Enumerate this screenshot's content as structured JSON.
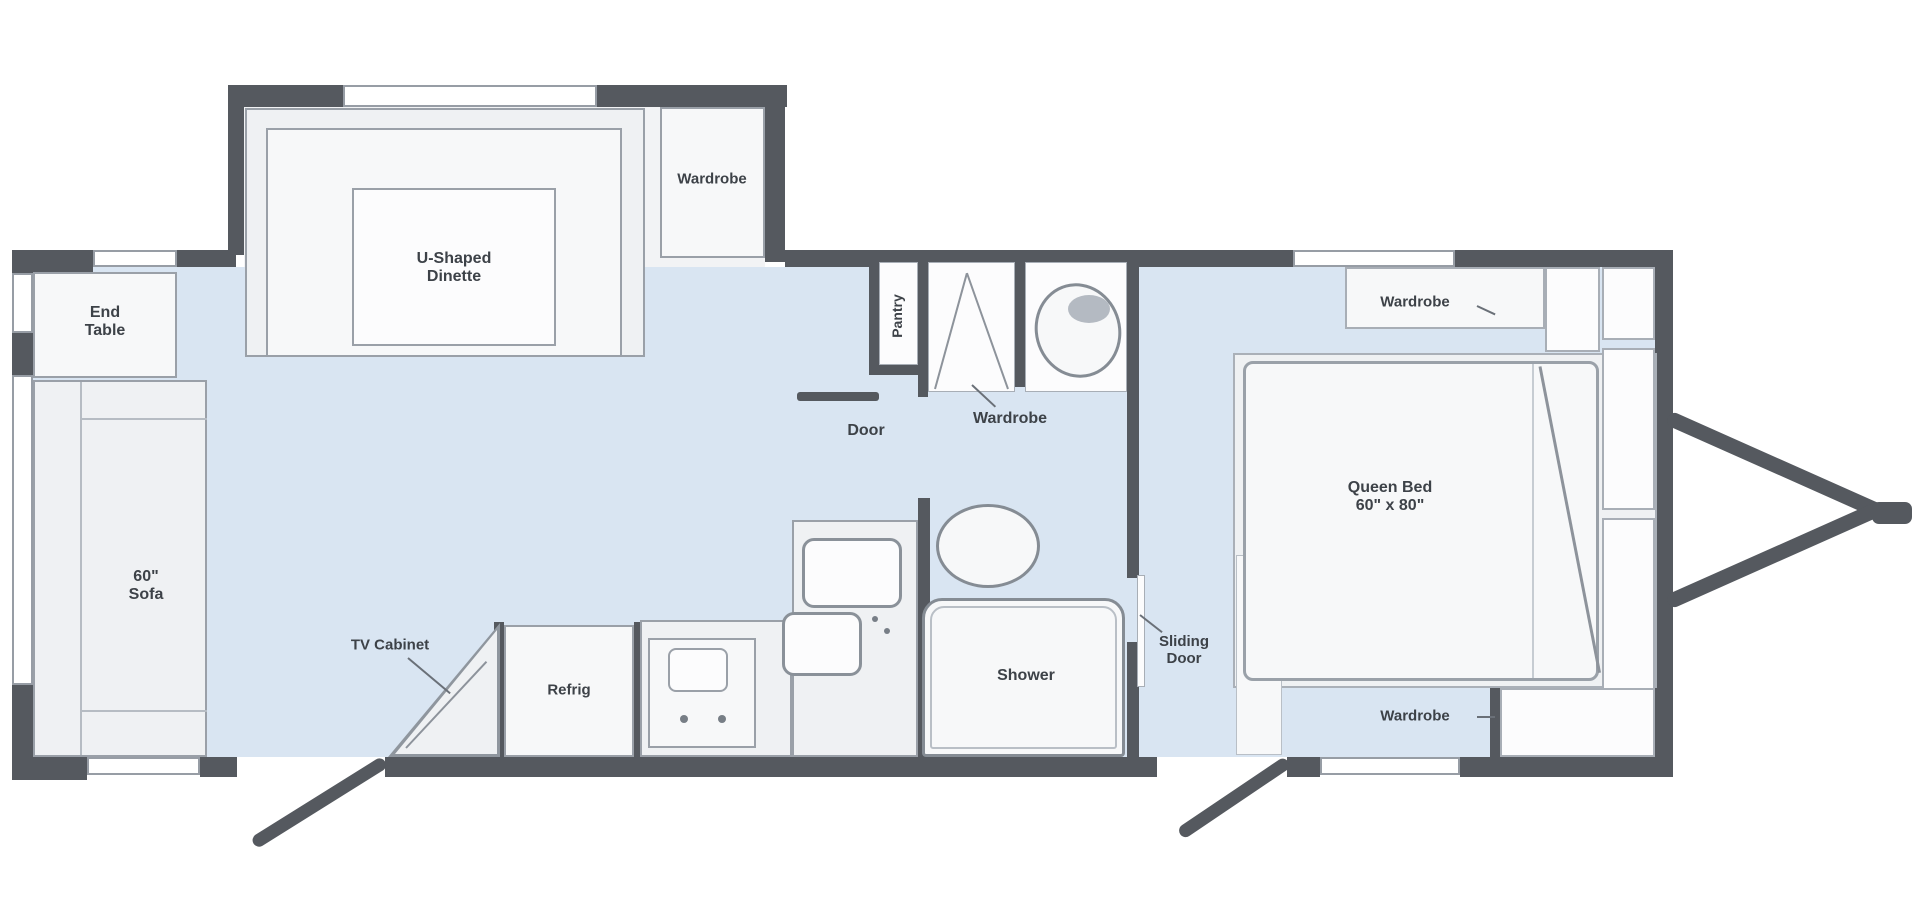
{
  "plan_title": "Travel Trailer Floor Plan",
  "colors": {
    "wall": "#55595f",
    "floor": "#d9e5f2",
    "furniture": "#eff1f3",
    "border": "#9aa0a8",
    "text": "#3d4248"
  },
  "labels": {
    "end_table": "End\nTable",
    "sofa": "60\"\nSofa",
    "dinette": "U-Shaped\nDinette",
    "wardrobe_slide": "Wardrobe",
    "pantry": "Pantry",
    "door": "Door",
    "wardrobe_mid": "Wardrobe",
    "shower": "Shower",
    "sliding_door": "Sliding\nDoor",
    "queen_bed": "Queen Bed\n60\" x 80\"",
    "wardrobe_top_right": "Wardrobe",
    "wardrobe_bottom_right": "Wardrobe",
    "tv_cabinet": "TV Cabinet",
    "refrig": "Refrig"
  }
}
